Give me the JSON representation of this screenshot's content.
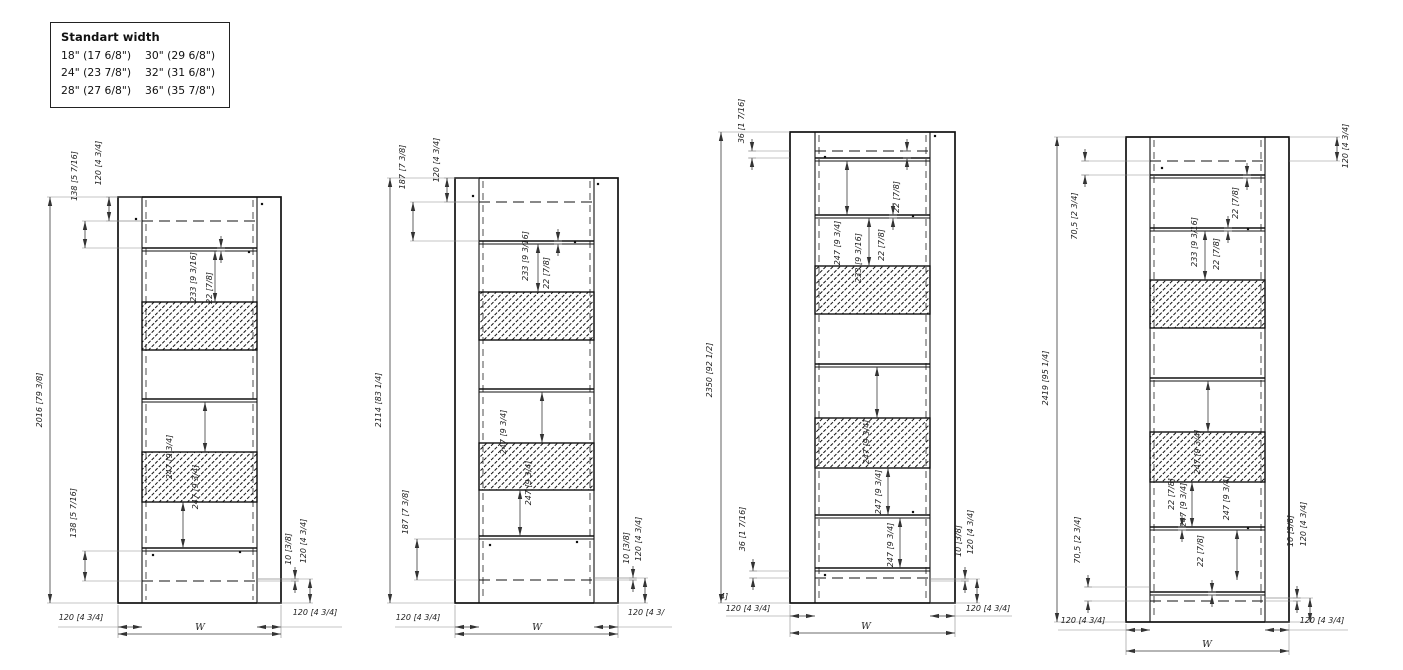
{
  "legend": {
    "title": "Standart width",
    "rows": [
      [
        "18\" (17 6/8\")",
        "30\" (29 6/8\")"
      ],
      [
        "24\" (23 7/8\")",
        "32\" (31 6/8\")"
      ],
      [
        "28\" (27 6/8\")",
        "36\" (35 7/8\")"
      ]
    ]
  },
  "colors": {
    "line": "#111111",
    "dim_text": "#222222",
    "ext_line": "#8a8a8a",
    "background": "#ffffff"
  },
  "drawings": [
    {
      "name": "door-frame-2016",
      "frame": {
        "x1": 118,
        "y1": 197,
        "x2": 281,
        "y2": 603,
        "il": 142,
        "ir": 257
      },
      "dashes": [
        221,
        581
      ],
      "rails": [
        248,
        399,
        548
      ],
      "bands": [
        [
          302,
          350
        ],
        [
          452,
          502
        ]
      ],
      "dots": [
        [
          136,
          219
        ],
        [
          262,
          204
        ],
        [
          249,
          252
        ],
        [
          153,
          555
        ],
        [
          240,
          552
        ]
      ],
      "vdims": [
        {
          "x": 50,
          "y1": 197,
          "y2": 603,
          "label": "2016 [79 3/8]",
          "lx": 42,
          "ly": 400,
          "ex": 118
        },
        {
          "x": 109,
          "y1": 197,
          "y2": 221,
          "label": "120 [4 3/4]",
          "lx": 101,
          "ly": 163,
          "ex": 142
        },
        {
          "x": 85,
          "y1": 221,
          "y2": 248,
          "label": "138 [5 7/16]",
          "lx": 77,
          "ly": 176,
          "ex": 142
        },
        {
          "x": 215,
          "y1": 251,
          "y2": 302,
          "label": "233 [9 3/16]",
          "lx": 196,
          "ly": 277
        },
        {
          "x": 221,
          "y1": 248,
          "y2": 251,
          "label": "22 [7/8]",
          "lx": 212,
          "ly": 288,
          "out": true
        },
        {
          "x": 205,
          "y1": 402,
          "y2": 452,
          "label": "247 [9 3/4]",
          "lx": 198,
          "ly": 487
        },
        {
          "x": 183,
          "y1": 502,
          "y2": 548,
          "label": "247 [9 3/4]",
          "lx": 172,
          "ly": 457
        },
        {
          "x": 85,
          "y1": 551,
          "y2": 581,
          "label": "138 [5 7/16]",
          "lx": 76,
          "ly": 513,
          "ex": 142
        },
        {
          "x": 295,
          "y1": 579,
          "y2": 581,
          "label": "10 [3/8]",
          "lx": 291,
          "ly": 549,
          "out": true,
          "ex": 257
        },
        {
          "x": 310,
          "y1": 579,
          "y2": 603,
          "label": "120 [4 3/4]",
          "lx": 306,
          "ly": 541,
          "ex": 257
        }
      ],
      "hdims": [
        {
          "y": 627,
          "x1": 118,
          "x2": 142,
          "label": "120 [4 3/4]",
          "lx": 81,
          "ly": 620,
          "tail": 58
        },
        {
          "y": 627,
          "x1": 257,
          "x2": 281,
          "label": "120 [4 3/4]",
          "lx": 315,
          "ly": 615,
          "tail": 342
        },
        {
          "y": 634,
          "x1": 118,
          "x2": 281,
          "label": "W",
          "lx": 200,
          "ly": 630,
          "ey": 603
        }
      ],
      "notes": []
    },
    {
      "name": "door-frame-2114",
      "frame": {
        "x1": 455,
        "y1": 178,
        "x2": 618,
        "y2": 603,
        "il": 479,
        "ir": 594
      },
      "dashes": [
        202,
        580
      ],
      "rails": [
        241,
        389,
        536
      ],
      "bands": [
        [
          292,
          340
        ],
        [
          443,
          490
        ]
      ],
      "dots": [
        [
          473,
          196
        ],
        [
          598,
          184
        ],
        [
          575,
          242
        ],
        [
          490,
          545
        ],
        [
          577,
          542
        ]
      ],
      "vdims": [
        {
          "x": 390,
          "y1": 178,
          "y2": 603,
          "label": "2114 [83 1/4]",
          "lx": 381,
          "ly": 400,
          "ex": 455
        },
        {
          "x": 447,
          "y1": 178,
          "y2": 202,
          "label": "120 [4 3/4]",
          "lx": 439,
          "ly": 160,
          "ex": 479
        },
        {
          "x": 413,
          "y1": 202,
          "y2": 241,
          "label": "187 [7 3/8]",
          "lx": 405,
          "ly": 167,
          "ex": 479
        },
        {
          "x": 538,
          "y1": 244,
          "y2": 292,
          "label": "233 [9 3/16]",
          "lx": 528,
          "ly": 256
        },
        {
          "x": 558,
          "y1": 241,
          "y2": 244,
          "label": "22 [7/8]",
          "lx": 549,
          "ly": 273,
          "out": true
        },
        {
          "x": 542,
          "y1": 392,
          "y2": 443,
          "label": "247 [9 3/4]",
          "lx": 506,
          "ly": 432
        },
        {
          "x": 520,
          "y1": 490,
          "y2": 536,
          "label": "247 [9 3/4]",
          "lx": 531,
          "ly": 483
        },
        {
          "x": 417,
          "y1": 539,
          "y2": 580,
          "label": "187 [7 3/8]",
          "lx": 408,
          "ly": 512,
          "ex": 479
        },
        {
          "x": 633,
          "y1": 578,
          "y2": 580,
          "label": "10 [3/8]",
          "lx": 629,
          "ly": 548,
          "out": true,
          "ex": 594
        },
        {
          "x": 645,
          "y1": 578,
          "y2": 603,
          "label": "120 [4 3/4]",
          "lx": 641,
          "ly": 539,
          "ex": 594
        }
      ],
      "hdims": [
        {
          "y": 627,
          "x1": 455,
          "x2": 479,
          "label": "120 [4 3/4]",
          "lx": 418,
          "ly": 620,
          "tail": 395
        },
        {
          "y": 627,
          "x1": 594,
          "x2": 618,
          "label": "120 [4 3/",
          "lx": 646,
          "ly": 615,
          "tail": 672
        },
        {
          "y": 634,
          "x1": 455,
          "x2": 618,
          "label": "W",
          "lx": 537,
          "ly": 630,
          "ey": 603
        }
      ],
      "notes": []
    },
    {
      "name": "door-frame-2350",
      "frame": {
        "x1": 790,
        "y1": 132,
        "x2": 955,
        "y2": 603,
        "il": 815,
        "ir": 930
      },
      "dashes": [
        151,
        578
      ],
      "rails": [
        158,
        215,
        364,
        515,
        568
      ],
      "bands": [
        [
          266,
          314
        ],
        [
          418,
          468
        ]
      ],
      "dots": [
        [
          825,
          157
        ],
        [
          935,
          136
        ],
        [
          913,
          216
        ],
        [
          913,
          512
        ],
        [
          825,
          575
        ]
      ],
      "vdims": [
        {
          "x": 721,
          "y1": 132,
          "y2": 603,
          "label": "2350 [92 1/2]",
          "lx": 712,
          "ly": 370,
          "ex": 790
        },
        {
          "x": 752,
          "y1": 151,
          "y2": 158,
          "label": "36 [1 7/16]",
          "lx": 744,
          "ly": 121,
          "out": true,
          "ex": 790
        },
        {
          "x": 847,
          "y1": 161,
          "y2": 215,
          "label": "247 [9 3/4]",
          "lx": 840,
          "ly": 243
        },
        {
          "x": 907,
          "y1": 151,
          "y2": 158,
          "label": "22 [7/8]",
          "lx": 899,
          "ly": 197,
          "out": true
        },
        {
          "x": 893,
          "y1": 215,
          "y2": 218,
          "label": "22 [7/8]",
          "lx": 884,
          "ly": 245,
          "out": true
        },
        {
          "x": 869,
          "y1": 218,
          "y2": 266,
          "label": "233 [9 3/16]",
          "lx": 861,
          "ly": 258
        },
        {
          "x": 877,
          "y1": 367,
          "y2": 418,
          "label": "247 [9 3/4]",
          "lx": 869,
          "ly": 442
        },
        {
          "x": 888,
          "y1": 468,
          "y2": 515,
          "label": "247 [9 3/4]",
          "lx": 881,
          "ly": 492
        },
        {
          "x": 900,
          "y1": 518,
          "y2": 568,
          "label": "247 [9 3/4]",
          "lx": 893,
          "ly": 545
        },
        {
          "x": 753,
          "y1": 571,
          "y2": 578,
          "label": "36 [1 7/16]",
          "lx": 745,
          "ly": 529,
          "out": true,
          "ex": 790
        },
        {
          "x": 965,
          "y1": 579,
          "y2": 581,
          "label": "10 [3/8]",
          "lx": 961,
          "ly": 541,
          "out": true,
          "ex": 930
        },
        {
          "x": 977,
          "y1": 579,
          "y2": 603,
          "label": "120 [4 3/4]",
          "lx": 973,
          "ly": 532,
          "ex": 930
        }
      ],
      "hdims": [
        {
          "y": 616,
          "x1": 790,
          "x2": 815,
          "label": "120 [4 3/4]",
          "lx": 748,
          "ly": 611,
          "tail": 726
        },
        {
          "y": 616,
          "x1": 930,
          "x2": 955,
          "label": "120 [4 3/4]",
          "lx": 988,
          "ly": 611,
          "tail": 1012
        },
        {
          "y": 633,
          "x1": 790,
          "x2": 955,
          "label": "W",
          "lx": 866,
          "ly": 629,
          "ey": 603
        }
      ],
      "notes": [
        {
          "x": 724,
          "y": 599,
          "label": "4]"
        }
      ]
    },
    {
      "name": "door-frame-2419",
      "frame": {
        "x1": 1126,
        "y1": 137,
        "x2": 1289,
        "y2": 622,
        "il": 1150,
        "ir": 1265
      },
      "dashes": [
        161,
        601
      ],
      "rails": [
        175,
        228,
        378,
        527,
        592
      ],
      "bands": [
        [
          280,
          328
        ],
        [
          432,
          482
        ]
      ],
      "dots": [
        [
          1162,
          168
        ],
        [
          1248,
          229
        ],
        [
          1248,
          528
        ]
      ],
      "vdims": [
        {
          "x": 1057,
          "y1": 137,
          "y2": 622,
          "label": "2419 [95 1/4]",
          "lx": 1048,
          "ly": 378,
          "ex": 1126
        },
        {
          "x": 1085,
          "y1": 161,
          "y2": 175,
          "label": "70,5 [2 3/4]",
          "lx": 1077,
          "ly": 216,
          "out": true,
          "ex": 1150
        },
        {
          "x": 1337,
          "y1": 137,
          "y2": 161,
          "label": "120 [4 3/4]",
          "lx": 1348,
          "ly": 146,
          "ex": 1289
        },
        {
          "x": 1247,
          "y1": 175,
          "y2": 178,
          "label": "22 [7/8]",
          "lx": 1238,
          "ly": 203,
          "out": true
        },
        {
          "x": 1228,
          "y1": 228,
          "y2": 231,
          "label": "22 [7/8]",
          "lx": 1219,
          "ly": 254,
          "out": true
        },
        {
          "x": 1205,
          "y1": 231,
          "y2": 280,
          "label": "233 [9 3/16]",
          "lx": 1197,
          "ly": 242
        },
        {
          "x": 1208,
          "y1": 381,
          "y2": 432,
          "label": "247 [9 3/4]",
          "lx": 1200,
          "ly": 452
        },
        {
          "x": 1192,
          "y1": 482,
          "y2": 527,
          "label": "247 [9 3/4]",
          "lx": 1186,
          "ly": 505
        },
        {
          "x": 1237,
          "y1": 530,
          "y2": 580,
          "label": "247 [9 3/4]",
          "lx": 1229,
          "ly": 498
        },
        {
          "x": 1182,
          "y1": 527,
          "y2": 530,
          "label": "22 [7/8]",
          "lx": 1174,
          "ly": 494,
          "out": true
        },
        {
          "x": 1212,
          "y1": 592,
          "y2": 595,
          "label": "22 [7/8]",
          "lx": 1203,
          "ly": 551,
          "out": true
        },
        {
          "x": 1088,
          "y1": 587,
          "y2": 601,
          "label": "70,5 [2 3/4]",
          "lx": 1080,
          "ly": 540,
          "out": true,
          "ex": 1150
        },
        {
          "x": 1297,
          "y1": 598,
          "y2": 601,
          "label": "10 [3/8]",
          "lx": 1293,
          "ly": 531,
          "out": true,
          "ex": 1265
        },
        {
          "x": 1310,
          "y1": 598,
          "y2": 622,
          "label": "120 [4 3/4]",
          "lx": 1306,
          "ly": 524,
          "ex": 1265
        }
      ],
      "hdims": [
        {
          "y": 630,
          "x1": 1126,
          "x2": 1150,
          "label": "120 [4 3/4]",
          "lx": 1083,
          "ly": 623,
          "tail": 1058
        },
        {
          "y": 630,
          "x1": 1265,
          "x2": 1289,
          "label": "120 [4 3/4]",
          "lx": 1322,
          "ly": 623,
          "tail": 1348
        },
        {
          "y": 651,
          "x1": 1126,
          "x2": 1289,
          "label": "W",
          "lx": 1207,
          "ly": 647,
          "ey": 622
        }
      ],
      "notes": []
    }
  ]
}
